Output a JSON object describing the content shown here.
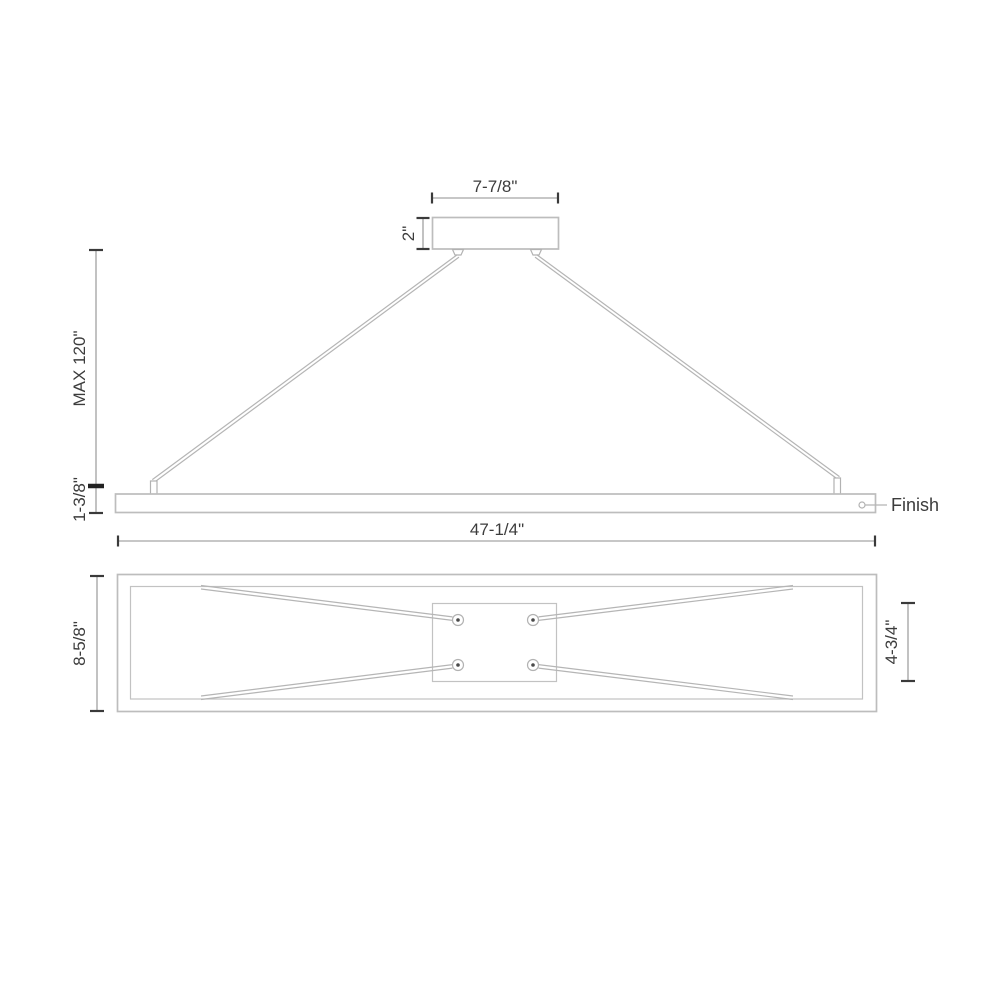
{
  "diagram": {
    "colors": {
      "background": "#ffffff",
      "outline_gray": "#bdbdbd",
      "detail_gray": "#c2c2c2",
      "cable_gray": "#b5b5b5",
      "dimension_line_gray": "#8f8f8f",
      "dimension_tick": "#3a3a3a",
      "text": "#3c3c3c"
    },
    "side_view": {
      "canopy_width_label": "7-7/8\"",
      "canopy_height_label": "2\"",
      "max_height_label": "MAX 120\"",
      "fixture_height_label": "1-3/8\"",
      "fixture_length_label": "47-1/4\"",
      "finish_callout_label": "Finish"
    },
    "bottom_view": {
      "fixture_width_label": "8-5/8\"",
      "canopy_plate_width_label": "4-3/4\""
    }
  }
}
